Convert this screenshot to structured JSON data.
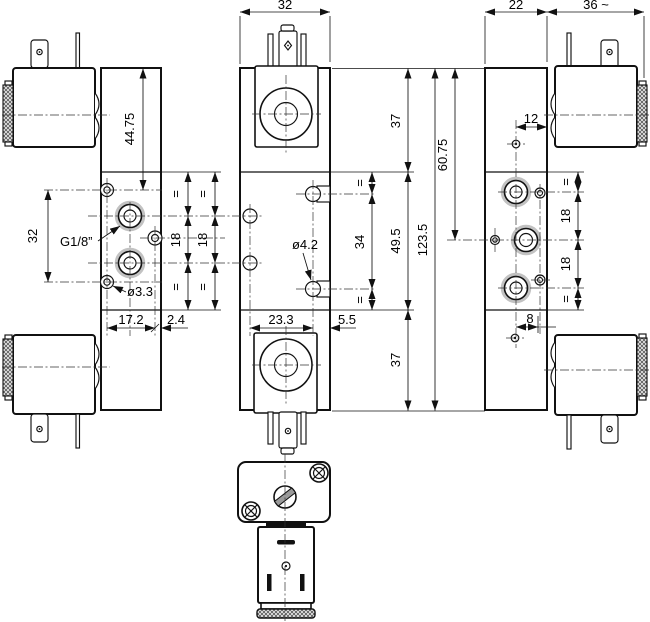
{
  "drawing": {
    "kind": "dimensional engineering drawing",
    "component": "dual-solenoid pneumatic valve",
    "views": {
      "left": {
        "dims": {
          "height_to_port": "44.75",
          "mount_hole_span": "32",
          "depth_port_face": "17.2",
          "depth_edge": "2.4",
          "equal": "=",
          "port_pitch": "18"
        },
        "labels": {
          "port_thread": "G1/8”",
          "mount_hole_dia": "ø3.3"
        }
      },
      "front": {
        "dims": {
          "width": "32",
          "solenoid_top": "37",
          "body_mid": "49.5",
          "solenoid_bottom": "37",
          "tab_hole_span": "34",
          "total_height": "123.5",
          "hole_span_x": "23.3",
          "tab_offset_x": "5.5",
          "equal": "="
        },
        "labels": {
          "tab_hole_dia": "ø4.2"
        }
      },
      "right": {
        "dims": {
          "depth": "22",
          "solenoid_length": "36 ~",
          "hole_to_edge": "12",
          "height_to_mid_port": "60.75",
          "port_pitch": "18",
          "hole_offset_x": "8",
          "equal": "="
        }
      }
    }
  }
}
